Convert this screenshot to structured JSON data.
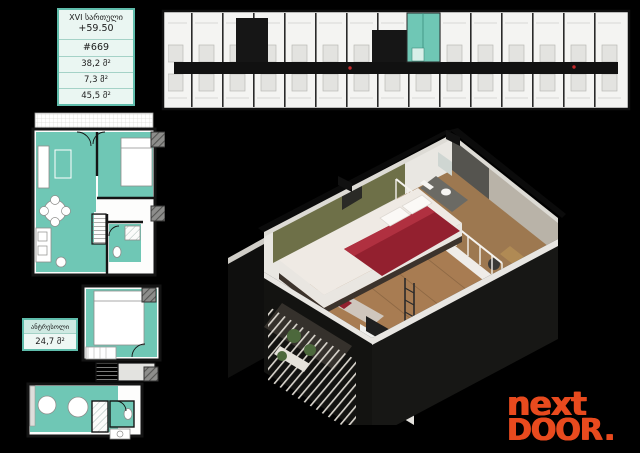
{
  "info_box": {
    "floor": "XVI სართული",
    "elevation": "+59.50",
    "unit": "#669",
    "area_1": "38,2 მ²",
    "area_2": "7,3 მ²",
    "area_3": "45,5 მ²"
  },
  "mezzanine_box": {
    "title": "ანტრესოლი",
    "area": "24,7 მ²"
  },
  "logo": {
    "line1": "next",
    "line2": "DOOR",
    "dot": "."
  },
  "colors": {
    "background": "#000000",
    "teal": "#6fc7b5",
    "teal_light": "#cfe9e2",
    "teal_border": "#5fbcab",
    "info_bg": "#eaf6f2",
    "plan_bg": "#f4f4f2",
    "wall": "#141414",
    "logo_orange": "#e84a1e",
    "wood": "#a87c52",
    "accent_olive": "#6e7048",
    "blanket_red": "#93202f"
  }
}
